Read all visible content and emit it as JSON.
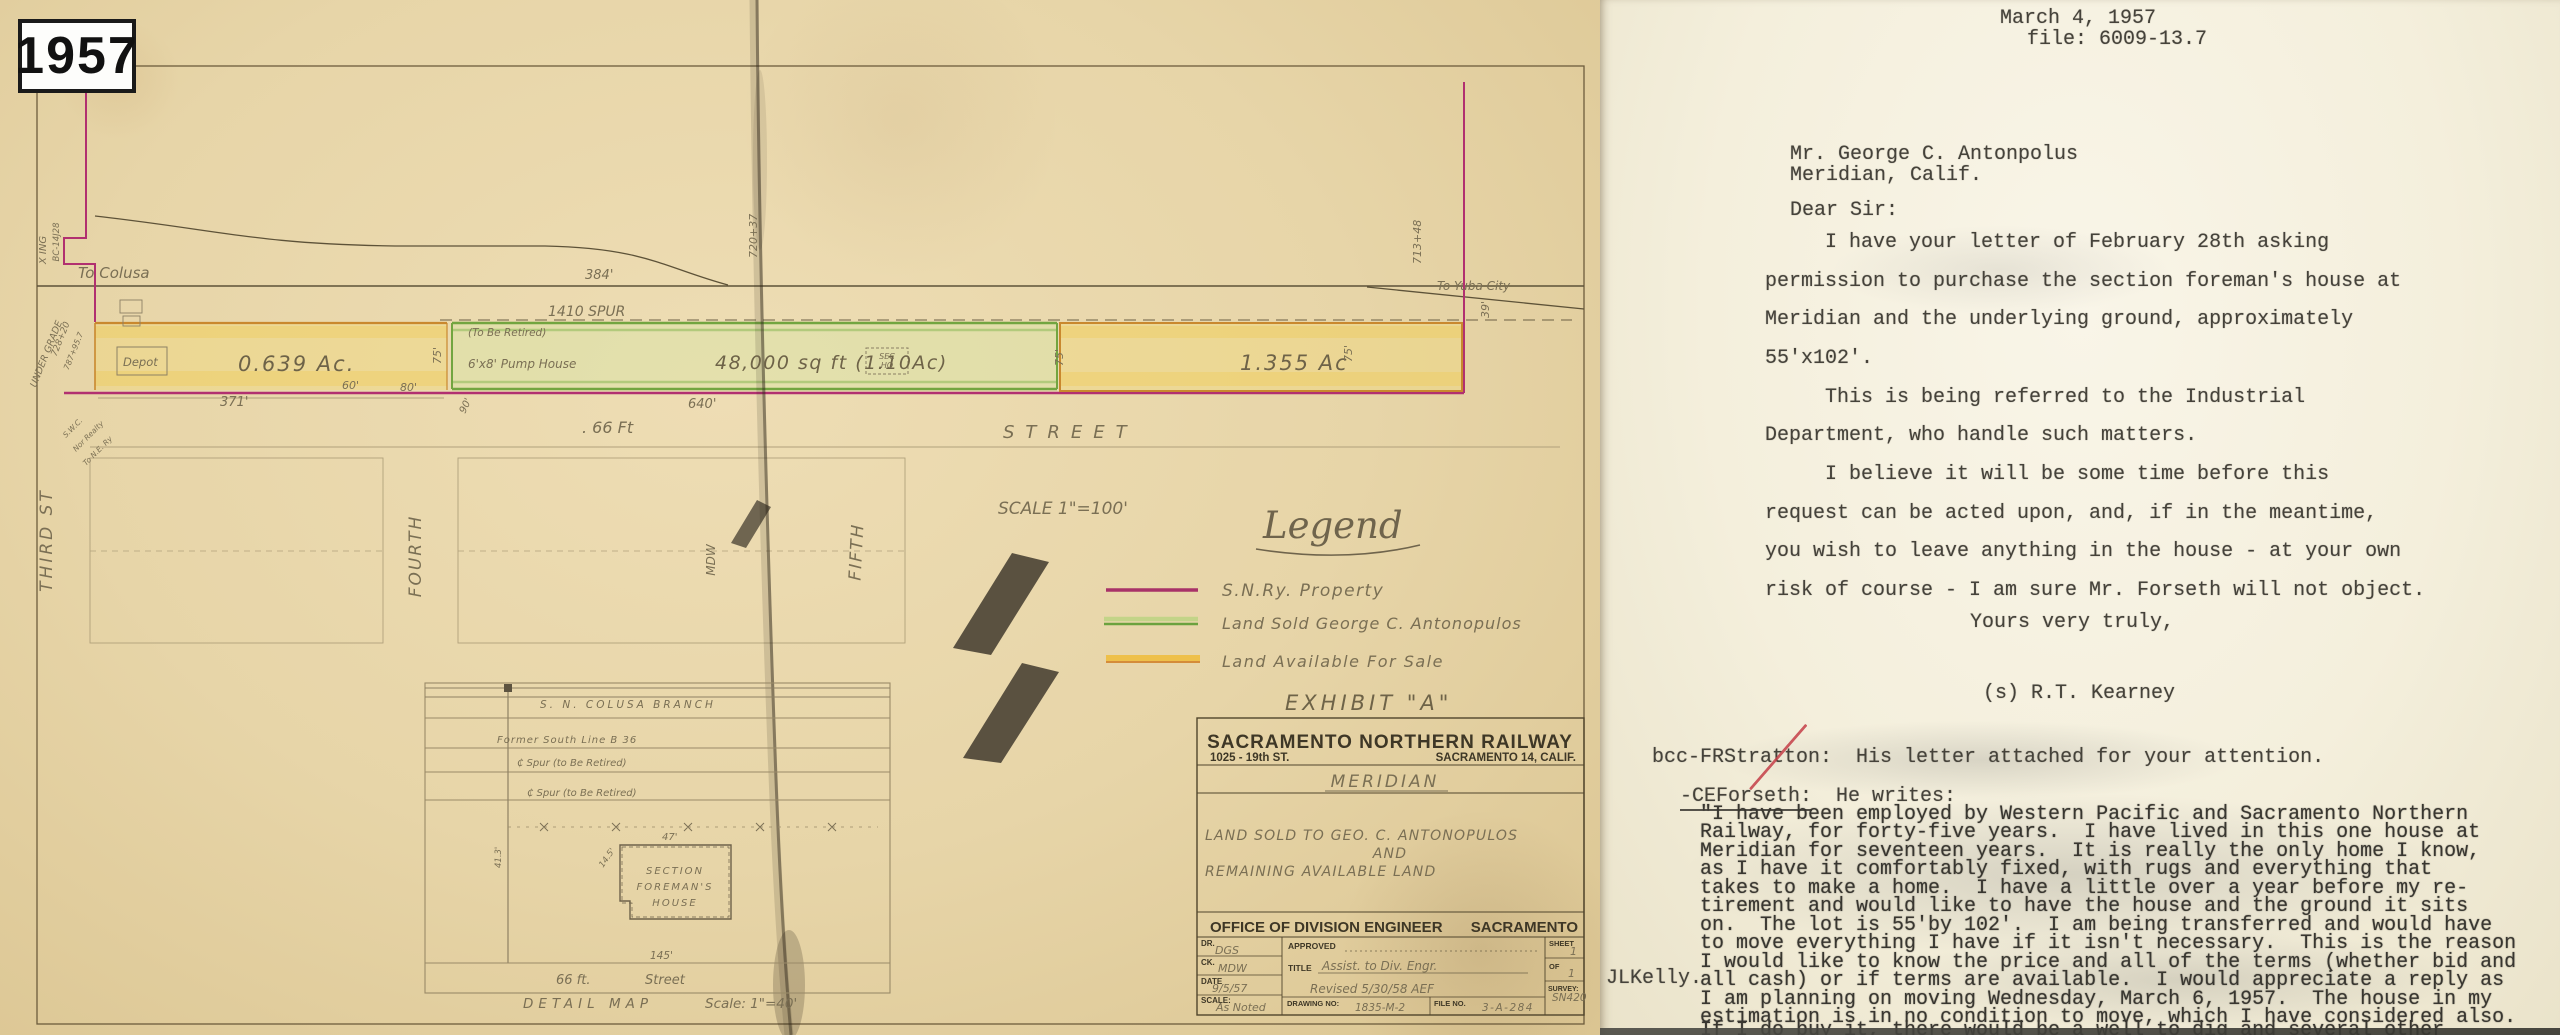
{
  "map": {
    "year_badge": "1957",
    "labels": {
      "to_colusa": "To Colusa",
      "to_yuba_city": "To Yuba City",
      "sta_720": "720+37",
      "sta_713": "713+48",
      "dim_39": "39'",
      "dim_384": "384'",
      "spur_name": "1410  SPUR",
      "to_be_retired": "(To Be Retired)",
      "depot": "Depot",
      "acreage_left": "0.639 Ac.",
      "dim_371": "371'",
      "dim_60": "60'",
      "dim_80": "80'",
      "dim_90": "90'",
      "dim_75a": "75'",
      "dim_75b": "75'",
      "dim_75c": "75'",
      "pump_house": "6'x8' Pump House",
      "sqft": "48,000 sq ft  (1.10Ac)",
      "sec_line1": "SEC",
      "sec_line2": "HO",
      "dim_640": "640'",
      "acreage_right": "1.355 Ac",
      "ft_66": ". 66 Ft",
      "street": "STREET",
      "scale_note": "SCALE 1\"=100'",
      "third_st": "THIRD  ST",
      "fourth_st": "FOURTH",
      "fifth_st": "FIFTH",
      "mdw": "MDW",
      "xing": "X ING",
      "bc_note": "BC-14J28",
      "under_grade": "UNDER GRADE",
      "sta_728": "728+20",
      "sta_787": "787+95.7",
      "swc": "S.W.C.",
      "nor_realty": "Nor Realty",
      "to_ne_ry": "To N.E. Ry"
    },
    "legend": {
      "title": "Legend",
      "items": [
        {
          "label": "S.N.Ry.  Property",
          "color": "#a83268"
        },
        {
          "label": "Land Sold George C. Antonopulos",
          "color": "#6ba23e"
        },
        {
          "label": "Land Available For Sale",
          "color": "#e8b33c"
        }
      ]
    },
    "exhibit": "EXHIBIT  \"A\"",
    "title_block": {
      "company": "SACRAMENTO NORTHERN RAILWAY",
      "address": "1025 - 19th ST.",
      "city": "SACRAMENTO 14, CALIF.",
      "location": "MERIDIAN",
      "desc_line1": "LAND SOLD TO GEO. C. ANTONOPULOS",
      "desc_line2": "AND",
      "desc_line3": "REMAINING AVAILABLE LAND",
      "office": "OFFICE OF DIVISION ENGINEER",
      "office_city": "SACRAMENTO",
      "dr_label": "DR.",
      "dr_value": "DGS",
      "ck_label": "CK.",
      "ck_value": "MDW",
      "date_label": "DATE",
      "date_value": "9/5/57",
      "scale_label": "SCALE:",
      "scale_value": "As Noted",
      "approved_label": "APPROVED",
      "title_label": "TITLE",
      "title_value": "Assist. to Div. Engr.",
      "revised_note": "Revised 5/30/58  AEF",
      "drawing_label": "DRAWING NO:",
      "drawing_value": "1835-M-2",
      "file_label": "FILE NO.",
      "file_value": "3-A-284",
      "sheet_label": "SHEET",
      "sheet_value": "1",
      "of_label": "OF",
      "of_value": "1",
      "survey_label": "SURVEY:",
      "survey_value": "SN420"
    },
    "detail_map": {
      "branch": "S. N.  COLUSA  BRANCH",
      "former_line": "Former  South  Line  B 36",
      "spur1": "₵ Spur  (to Be Retired)",
      "spur2": "₵ Spur  (to Be Retired)",
      "house_line1": "SECTION",
      "house_line2": "FOREMAN'S",
      "house_line3": "HOUSE",
      "dim_47": "47'",
      "dim_145": "145'",
      "dim_14_5": "14.5'",
      "dim_41_3": "41.3'",
      "street_width": "66 ft.",
      "street_name": "Street",
      "caption": "DETAIL  MAP",
      "caption_scale": "Scale: 1\"=40'"
    }
  },
  "letter": {
    "date": "March 4, 1957",
    "file_no": "file: 6009-13.7",
    "recipient_line1": "Mr. George C. Antonpolus",
    "recipient_line2": "Meridian, Calif.",
    "salutation": "Dear Sir:",
    "body_lines": [
      "I have your letter of February 28th asking",
      "permission to purchase the section foreman's house at",
      "Meridian and the underlying ground, approximately",
      "55'x102'.",
      "This is being referred to the Industrial",
      "Department, who handle such matters.",
      "I believe it will be some time before this",
      "request can be acted upon, and, if in the meantime,",
      "you wish to leave anything in the house - at your own",
      "risk of course - I am sure Mr. Forseth will not object."
    ],
    "closing": "Yours very truly,",
    "signature": "(s) R.T. Kearney",
    "bcc_line": "bcc-FRStratton:  His letter attached for your attention.",
    "forseth_prefix": "-CEForseth:",
    "forseth_rest": "  He writes:",
    "quote_lines": [
      "\"I have been employed by Western Pacific and Sacramento Northern",
      "Railway, for forty-five years.  I have lived in this one house at",
      "Meridian for seventeen years.  It is really the only home I know,",
      "as I have it comfortably fixed, with rugs and everything that",
      "takes to make a home.  I have a little over a year before my re-",
      "tirement and would like to have the house and the ground it sits",
      "on.  The lot is 55'by 102'.  I am being transferred and would have",
      "to move everything I have if it isn't necessary.  This is the reason",
      "I would like to know the price and all of the terms (whether bid and",
      "all cash) or if terms are available.  I would appreciate a reply as",
      "I am planning on moving Wednesday, March 6, 1957.  The house in my",
      "estimation is in no condition to move, which I have considered also.",
      "If I do buy it, there would be a well to dig and several other"
    ],
    "margin_initials": "JLKelly."
  }
}
